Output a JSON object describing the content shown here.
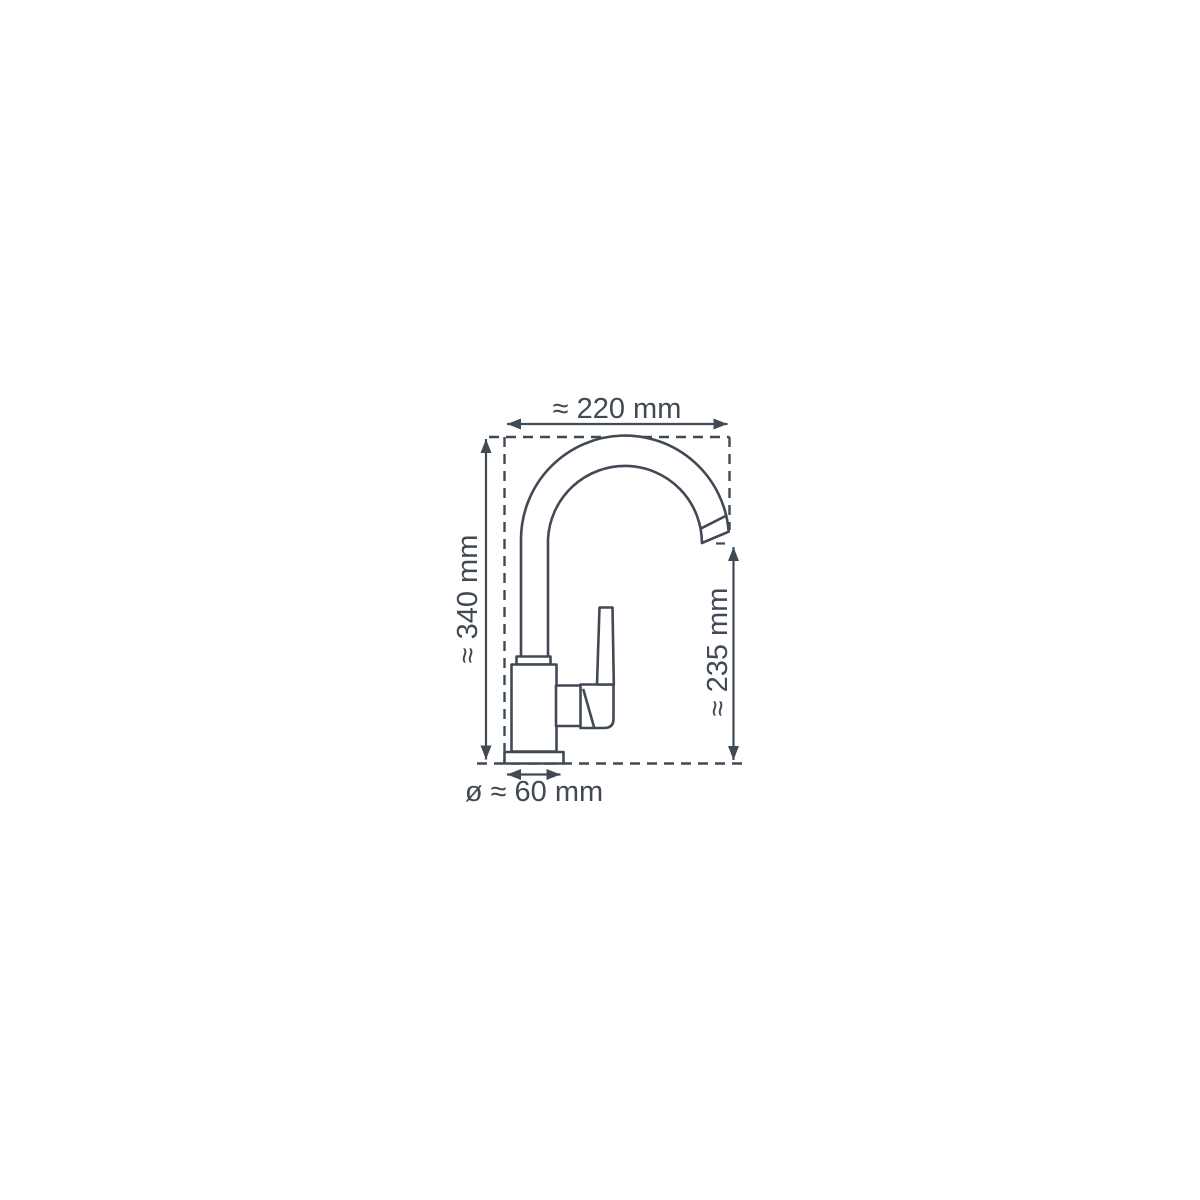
{
  "diagram": {
    "subject": "kitchen-faucet-technical-drawing",
    "background_color": "#ffffff",
    "line_color": "#414a54",
    "labels": {
      "width": "≈ 220 mm",
      "height_total": "≈ 340 mm",
      "height_spout": "≈ 235 mm",
      "base_diameter": "ø ≈ 60 mm"
    }
  }
}
